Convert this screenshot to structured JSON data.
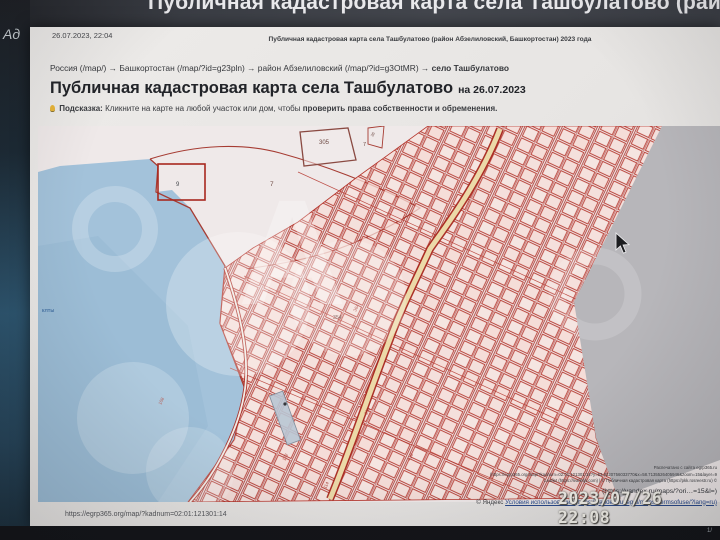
{
  "window_title": "Публичная кадастровая карта села Ташбулатово (район А",
  "photo_overlay": {
    "camera_timestamp": "2023/07/26 22:08",
    "page_indicator": "1/",
    "side_label": "Ад"
  },
  "page": {
    "printed_datetime": "26.07.2023, 22:04",
    "print_header": "Публичная кадастровая карта села Ташбулатово (район Абзелиловский, Башкортостан) 2023 года",
    "breadcrumb_pre": "Россия (/map/) → Башкортостан (/map/?id=g23pln) → район Абзелиловский (/map/?id=g3OtMR) → ",
    "breadcrumb_current": "село Ташбулатово",
    "title": "Публичная кадастровая карта села Ташбулатово",
    "title_date": "на 26.07.2023",
    "hint_icon": "lightbulb-icon",
    "hint_label": "Подсказка:",
    "hint_text": " Кликните на карте на любой участок или дом, чтобы ",
    "hint_bold": "проверить права собственности и обременения.",
    "footer_url": "https://egrp365.org/map/?kadnum=02:01:121301:14"
  },
  "map": {
    "watermark_letter": "А",
    "labels": {
      "lake": "клты",
      "q9": "9",
      "p305": "305",
      "p7a": "7",
      "p7b": "7",
      "p36": "36",
      "p354": "354",
      "p364": "364",
      "s108": "108",
      "s172": "172",
      "s230": "230",
      "s410": "410",
      "s114": "114"
    },
    "attribution": {
      "printed_from": "Распечатано с сайта egrp365.ru",
      "share_url": "(https://egrp365.org/map/?kadnum=02:01:121301:14?y=53.6320756033770&x=58.7135526405946&zoom=15&layer=9",
      "leaflet_line": "Leaflet (https://leafletjs.com) | © Публичная кадастровая карта (https://pkk.rosreestr.ru) ©",
      "yandex_url": "(https://yandex.ru/maps/?ori…=15&l=)",
      "yandex_copyright": "© Яндекс ",
      "yandex_terms": "Условия использования (https://yandex.ru/legal/maps_termsofuse/?lang=ru)"
    }
  },
  "colors": {
    "parcel_red": "#b5352c",
    "boundary_red": "#a63c33",
    "lake_blue": "#a3c2da",
    "land": "#f2edec",
    "unloaded_gray": "#b7b6ba",
    "road_tan": "#ecd9a8",
    "page_bg": "#e9e7e5",
    "bezel_dark": "#17181c"
  }
}
